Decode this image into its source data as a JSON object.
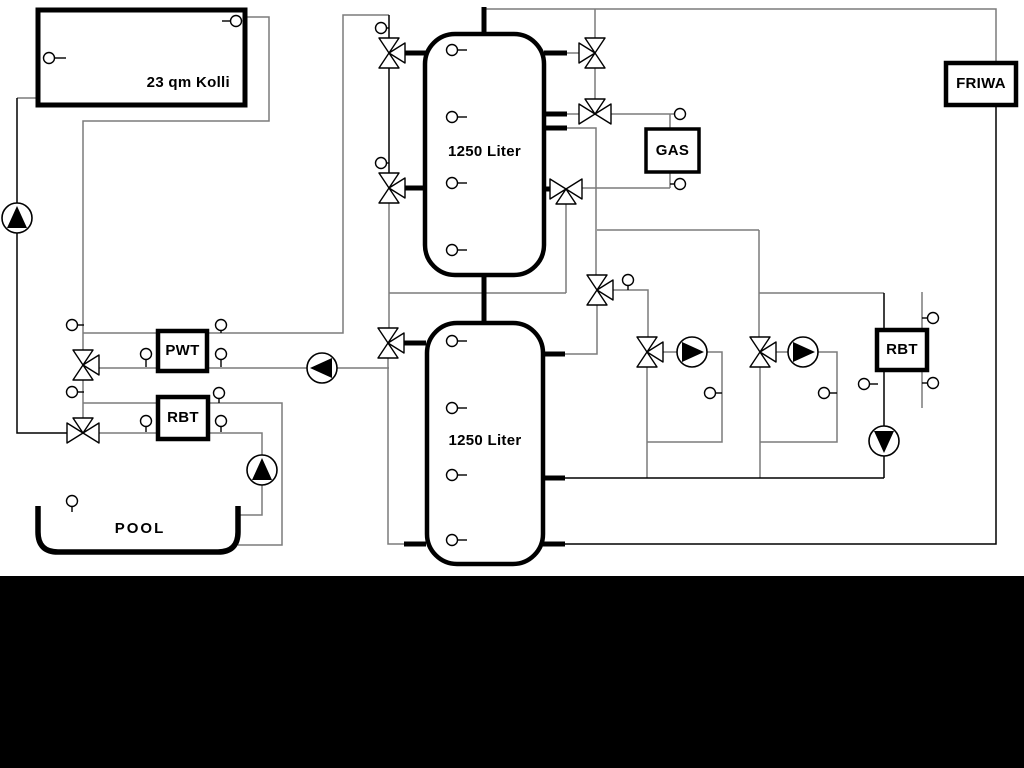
{
  "diagram": {
    "type": "hydraulic-scheme",
    "components": {
      "collector": {
        "label": "23 qm Kolli"
      },
      "buffer_tank_top": {
        "label": "1250 Liter"
      },
      "buffer_tank_bottom": {
        "label": "1250 Liter"
      },
      "gas_boiler": {
        "label": "GAS"
      },
      "friwa_station": {
        "label": "FRIWA"
      },
      "pwt_heat_exchanger": {
        "label": "PWT"
      },
      "rbt_left_heat_exchanger": {
        "label": "RBT"
      },
      "rbt_right_heat_exchanger": {
        "label": "RBT"
      },
      "pool": {
        "label": "POOL"
      }
    },
    "colors": {
      "background": "#ffffff",
      "bottom_bar": "#000000",
      "pipe_gray": "#7b7b7b",
      "pipe_black": "#000000",
      "component_stroke": "#000000",
      "component_fill": "#ffffff"
    }
  }
}
